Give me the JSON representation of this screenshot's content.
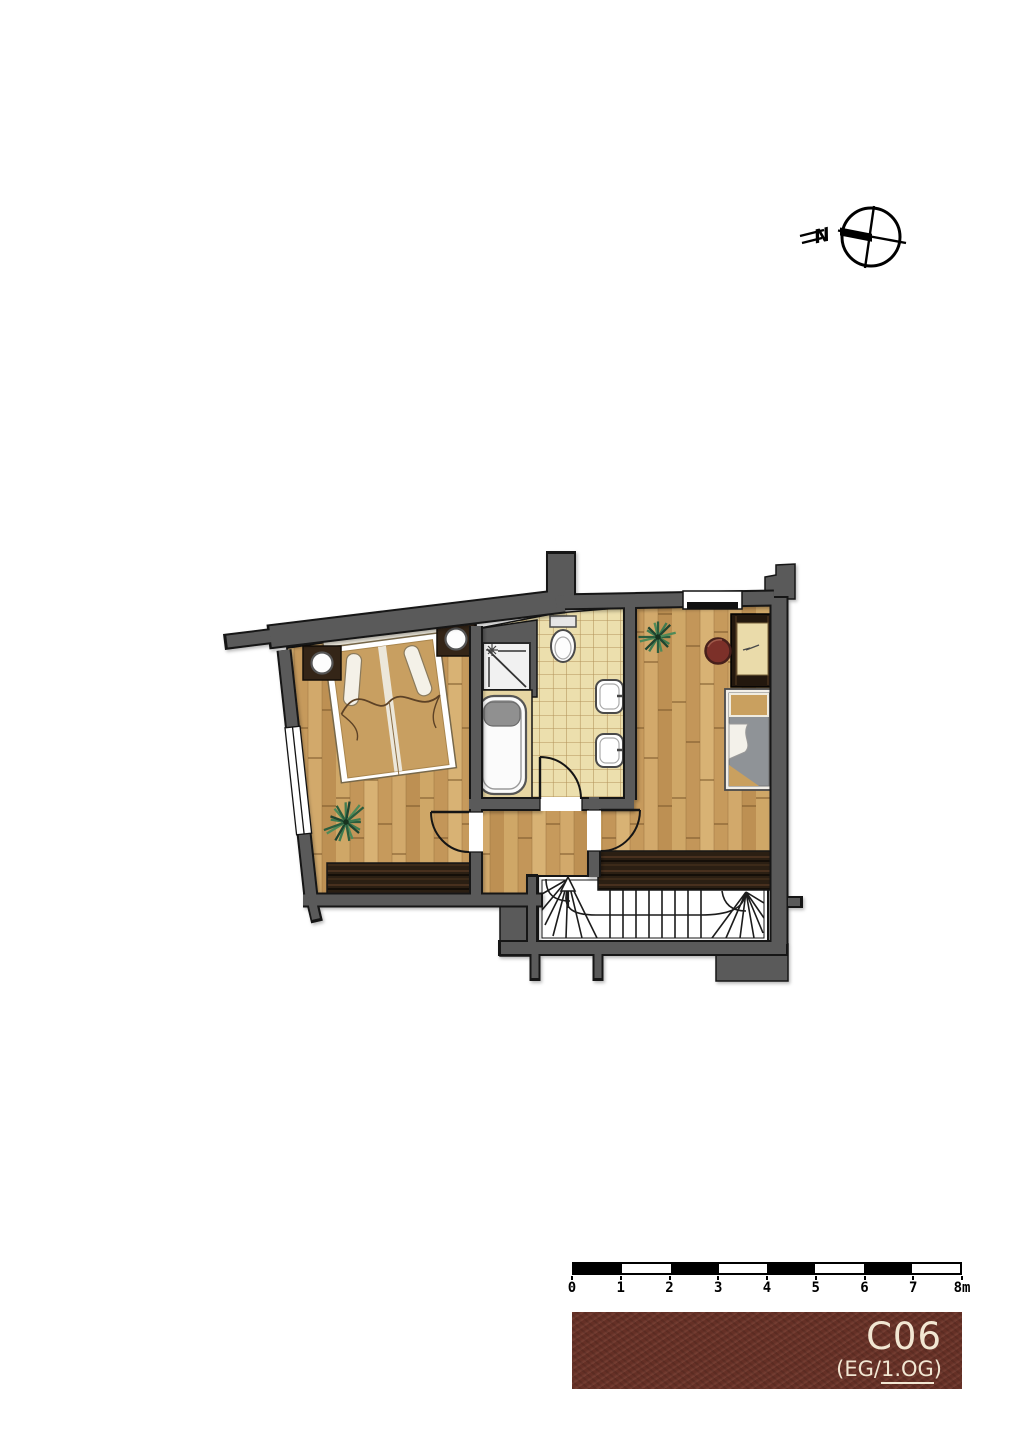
{
  "compass": {
    "label": "N"
  },
  "scale_bar": {
    "labels": [
      "0",
      "1",
      "2",
      "3",
      "4",
      "5",
      "6",
      "7",
      "8m"
    ],
    "segment_colors": [
      "#000000",
      "#ffffff"
    ],
    "unit": "m"
  },
  "title_box": {
    "unit": "C06",
    "floor_prefix": "(EG/",
    "floor_current": "1.OG",
    "floor_suffix": ")",
    "bg_color": "#6d3429",
    "text_color": "#f2e7d3"
  },
  "plan": {
    "colors": {
      "wall": "#5a5a5a",
      "outline": "#141414",
      "wood_floor": "#c9a05f",
      "tile_floor": "#ecdfad",
      "dark_wood": "#2b1f13",
      "fixture_white": "#ffffff",
      "blanket_gray": "#8f9397",
      "stool_red": "#7c3029",
      "plant_green": "#2c5e3e"
    },
    "rooms": [
      {
        "name": "bedroom",
        "floor": "wood"
      },
      {
        "name": "bathroom",
        "floor": "tile"
      },
      {
        "name": "hall",
        "floor": "wood"
      },
      {
        "name": "second-room",
        "floor": "wood"
      },
      {
        "name": "stairwell",
        "floor": "none"
      }
    ],
    "furniture": [
      "double-bed",
      "nightstand-left",
      "lamp-left",
      "nightstand-right",
      "lamp-right",
      "plant-bedroom",
      "plant-second-room",
      "shower",
      "bathtub",
      "toilet",
      "sink-upper",
      "sink-lower",
      "desk",
      "stool",
      "single-bed",
      "winder-staircase",
      "gallery-edge-left",
      "gallery-edge-right"
    ]
  }
}
